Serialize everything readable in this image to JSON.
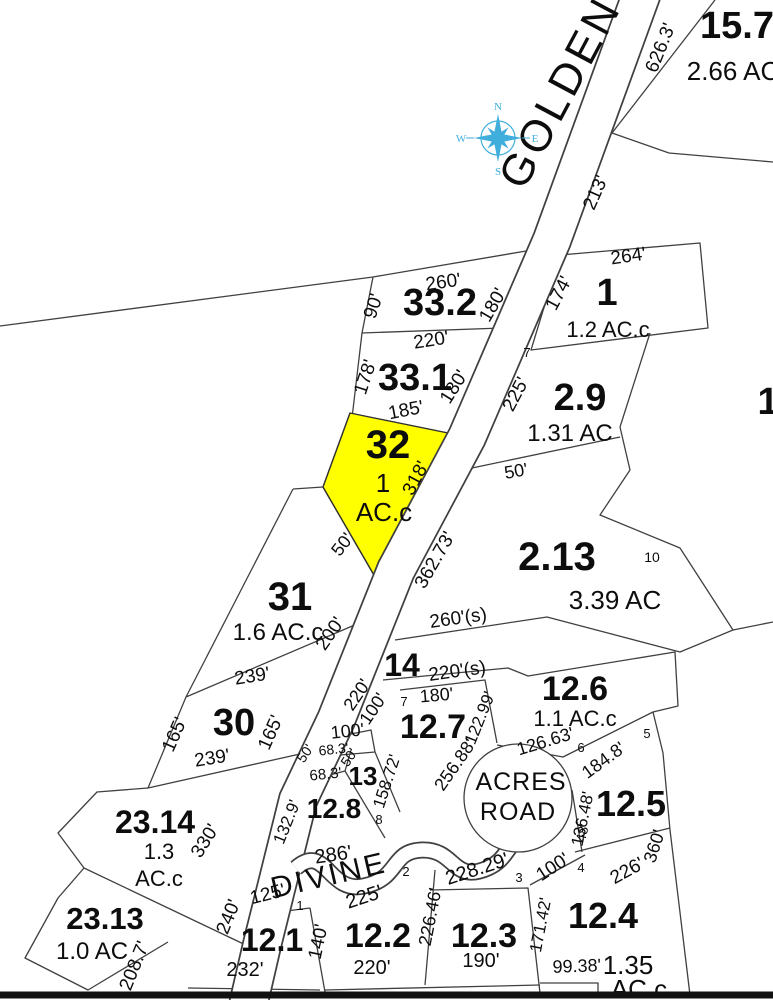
{
  "colors": {
    "highlight_parcel": "#ffff00",
    "compass": "#3FAEDC",
    "line": "#404040",
    "border": "#111111"
  },
  "compass": {
    "x": 498,
    "y": 138,
    "points": {
      "n": "N",
      "e": "E",
      "s": "S",
      "w": "W"
    }
  },
  "roads": [
    {
      "name": "GOLDEN",
      "t": "GOLDEN",
      "x": 573,
      "y": 99,
      "r": -62,
      "s": 44,
      "ls": 4
    },
    {
      "name": "DIVINE",
      "t": "DIVINE",
      "x": 331,
      "y": 885,
      "r": -13,
      "s": 30,
      "ls": 3
    },
    {
      "name": "ACRES",
      "t": "ACRES",
      "x": 521,
      "y": 790,
      "r": 0,
      "s": 25,
      "ls": 1
    },
    {
      "name": "ROAD",
      "t": "ROAD",
      "x": 518,
      "y": 820,
      "r": 0,
      "s": 25,
      "ls": 1
    }
  ],
  "parcel_numbers": [
    {
      "t": "15.7",
      "x": 737,
      "y": 38,
      "r": 0,
      "s": 38
    },
    {
      "t": "33.2",
      "x": 440,
      "y": 315,
      "r": 0,
      "s": 38
    },
    {
      "t": "33.1",
      "x": 415,
      "y": 390,
      "r": 0,
      "s": 38
    },
    {
      "t": "1",
      "x": 607,
      "y": 305,
      "r": 0,
      "s": 38
    },
    {
      "t": "2.9",
      "x": 580,
      "y": 410,
      "r": 0,
      "s": 38
    },
    {
      "t": "32",
      "x": 388,
      "y": 458,
      "r": 0,
      "s": 40
    },
    {
      "t": "31",
      "x": 290,
      "y": 610,
      "r": 0,
      "s": 40
    },
    {
      "t": "2.13",
      "x": 557,
      "y": 570,
      "r": 0,
      "s": 40
    },
    {
      "t": "30",
      "x": 234,
      "y": 735,
      "r": 0,
      "s": 38
    },
    {
      "t": "14",
      "x": 402,
      "y": 676,
      "r": 0,
      "s": 32
    },
    {
      "t": "12.7",
      "x": 433,
      "y": 738,
      "r": 0,
      "s": 34
    },
    {
      "t": "12.6",
      "x": 575,
      "y": 700,
      "r": 0,
      "s": 34
    },
    {
      "t": "12.5",
      "x": 631,
      "y": 816,
      "r": 0,
      "s": 36
    },
    {
      "t": "13",
      "x": 363,
      "y": 785,
      "r": 0,
      "s": 26
    },
    {
      "t": "12.8",
      "x": 334,
      "y": 818,
      "r": 0,
      "s": 28
    },
    {
      "t": "23.14",
      "x": 155,
      "y": 833,
      "r": 0,
      "s": 32
    },
    {
      "t": "23.13",
      "x": 105,
      "y": 929,
      "r": 0,
      "s": 31
    },
    {
      "t": "12.1",
      "x": 272,
      "y": 951,
      "r": 0,
      "s": 32
    },
    {
      "t": "12.2",
      "x": 378,
      "y": 947,
      "r": 0,
      "s": 34
    },
    {
      "t": "12.3",
      "x": 484,
      "y": 947,
      "r": 0,
      "s": 34
    },
    {
      "t": "12.4",
      "x": 603,
      "y": 928,
      "r": 0,
      "s": 36
    },
    {
      "t": "1",
      "x": 768,
      "y": 414,
      "r": 0,
      "s": 38
    }
  ],
  "areas": [
    {
      "t": "2.66 AC",
      "x": 733,
      "y": 80,
      "r": 0,
      "s": 26
    },
    {
      "t": "1.2 AC.c",
      "x": 608,
      "y": 337,
      "r": 0,
      "s": 22
    },
    {
      "t": "1.31 AC",
      "x": 570,
      "y": 441,
      "r": 0,
      "s": 24
    },
    {
      "t": "1",
      "x": 383,
      "y": 492,
      "r": 0,
      "s": 26
    },
    {
      "t": "AC.c",
      "x": 384,
      "y": 521,
      "r": 0,
      "s": 26
    },
    {
      "t": "1.6 AC.c",
      "x": 278,
      "y": 640,
      "r": 0,
      "s": 24
    },
    {
      "t": "3.39 AC",
      "x": 615,
      "y": 609,
      "r": 0,
      "s": 26
    },
    {
      "t": "1.1 AC.c",
      "x": 575,
      "y": 726,
      "r": 0,
      "s": 22
    },
    {
      "t": "1.3",
      "x": 159,
      "y": 859,
      "r": 0,
      "s": 22
    },
    {
      "t": "AC.c",
      "x": 159,
      "y": 886,
      "r": 0,
      "s": 22
    },
    {
      "t": "1.0 AC",
      "x": 92,
      "y": 959,
      "r": 0,
      "s": 24
    },
    {
      "t": "1.35",
      "x": 628,
      "y": 974,
      "r": 0,
      "s": 26
    },
    {
      "t": "AC.c",
      "x": 639,
      "y": 998,
      "r": 0,
      "s": 26
    }
  ],
  "lot_numbers": [
    {
      "t": "7",
      "x": 527,
      "y": 357,
      "r": 0,
      "s": 13
    },
    {
      "t": "10",
      "x": 652,
      "y": 562,
      "r": 0,
      "s": 14
    },
    {
      "t": "7",
      "x": 404,
      "y": 706,
      "r": 0,
      "s": 13
    },
    {
      "t": "6",
      "x": 581,
      "y": 752,
      "r": 0,
      "s": 13
    },
    {
      "t": "5",
      "x": 647,
      "y": 738,
      "r": 0,
      "s": 13
    },
    {
      "t": "8",
      "x": 379,
      "y": 824,
      "r": 0,
      "s": 13
    },
    {
      "t": "1",
      "x": 300,
      "y": 910,
      "r": 0,
      "s": 13
    },
    {
      "t": "2",
      "x": 406,
      "y": 876,
      "r": 0,
      "s": 13
    },
    {
      "t": "3",
      "x": 519,
      "y": 882,
      "r": 0,
      "s": 13
    },
    {
      "t": "4",
      "x": 581,
      "y": 872,
      "r": 0,
      "s": 13
    }
  ],
  "dimensions": [
    {
      "t": "626.3'",
      "x": 666,
      "y": 50,
      "r": -68,
      "s": 19
    },
    {
      "t": "213'",
      "x": 601,
      "y": 195,
      "r": -66,
      "s": 19
    },
    {
      "t": "260'",
      "x": 444,
      "y": 288,
      "r": -8,
      "s": 19
    },
    {
      "t": "90'",
      "x": 379,
      "y": 308,
      "r": -72,
      "s": 19
    },
    {
      "t": "180'",
      "x": 498,
      "y": 308,
      "r": -60,
      "s": 19
    },
    {
      "t": "264'",
      "x": 629,
      "y": 262,
      "r": -8,
      "s": 19
    },
    {
      "t": "174'",
      "x": 564,
      "y": 296,
      "r": -62,
      "s": 19
    },
    {
      "t": "220'",
      "x": 432,
      "y": 346,
      "r": -9,
      "s": 19
    },
    {
      "t": "178'",
      "x": 371,
      "y": 379,
      "r": -72,
      "s": 19
    },
    {
      "t": "180'",
      "x": 459,
      "y": 390,
      "r": -58,
      "s": 19
    },
    {
      "t": "185'",
      "x": 407,
      "y": 416,
      "r": -11,
      "s": 19
    },
    {
      "t": "225'",
      "x": 521,
      "y": 397,
      "r": -62,
      "s": 19
    },
    {
      "t": "50'",
      "x": 517,
      "y": 477,
      "r": -10,
      "s": 18
    },
    {
      "t": "318'",
      "x": 421,
      "y": 481,
      "r": -62,
      "s": 19
    },
    {
      "t": "50'",
      "x": 347,
      "y": 548,
      "r": -52,
      "s": 18
    },
    {
      "t": "362.73'",
      "x": 440,
      "y": 563,
      "r": -60,
      "s": 19
    },
    {
      "t": "200'",
      "x": 335,
      "y": 637,
      "r": -55,
      "s": 19
    },
    {
      "t": "260'(s)",
      "x": 459,
      "y": 624,
      "r": -8,
      "s": 19
    },
    {
      "t": "239'",
      "x": 253,
      "y": 682,
      "r": -9,
      "s": 19
    },
    {
      "t": "220'(s)",
      "x": 458,
      "y": 677,
      "r": -8,
      "s": 19
    },
    {
      "t": "165'",
      "x": 180,
      "y": 737,
      "r": -66,
      "s": 19
    },
    {
      "t": "165'",
      "x": 276,
      "y": 735,
      "r": -66,
      "s": 19
    },
    {
      "t": "239'",
      "x": 213,
      "y": 764,
      "r": -9,
      "s": 19
    },
    {
      "t": "220'",
      "x": 362,
      "y": 698,
      "r": -56,
      "s": 18
    },
    {
      "t": "100'",
      "x": 378,
      "y": 712,
      "r": -56,
      "s": 18
    },
    {
      "t": "180'",
      "x": 437,
      "y": 701,
      "r": -5,
      "s": 18
    },
    {
      "t": "100'",
      "x": 348,
      "y": 737,
      "r": -6,
      "s": 18
    },
    {
      "t": "50'",
      "x": 309,
      "y": 756,
      "r": -56,
      "s": 14
    },
    {
      "t": "68.3'",
      "x": 334,
      "y": 754,
      "r": -6,
      "s": 14
    },
    {
      "t": "50'",
      "x": 353,
      "y": 760,
      "r": -56,
      "s": 14
    },
    {
      "t": "68.3'",
      "x": 326,
      "y": 779,
      "r": -6,
      "s": 15
    },
    {
      "t": "158.72'",
      "x": 392,
      "y": 783,
      "r": -72,
      "s": 17
    },
    {
      "t": "122.99'",
      "x": 485,
      "y": 720,
      "r": -68,
      "s": 17
    },
    {
      "t": "256.88'",
      "x": 460,
      "y": 768,
      "r": -55,
      "s": 18
    },
    {
      "t": "126.63'",
      "x": 547,
      "y": 747,
      "r": -17,
      "s": 18
    },
    {
      "t": "184.8'",
      "x": 607,
      "y": 765,
      "r": -36,
      "s": 18
    },
    {
      "t": "136.48'",
      "x": 588,
      "y": 820,
      "r": -78,
      "s": 17
    },
    {
      "t": "360'",
      "x": 660,
      "y": 848,
      "r": -72,
      "s": 18
    },
    {
      "t": "330'",
      "x": 210,
      "y": 844,
      "r": -58,
      "s": 19
    },
    {
      "t": "208.7'",
      "x": 140,
      "y": 968,
      "r": -68,
      "s": 19
    },
    {
      "t": "132.9'",
      "x": 292,
      "y": 824,
      "r": -68,
      "s": 17
    },
    {
      "t": "286'",
      "x": 334,
      "y": 861,
      "r": -8,
      "s": 20
    },
    {
      "t": "240'",
      "x": 234,
      "y": 919,
      "r": -68,
      "s": 19
    },
    {
      "t": "125'",
      "x": 269,
      "y": 900,
      "r": -14,
      "s": 19
    },
    {
      "t": "232'",
      "x": 245,
      "y": 976,
      "r": 0,
      "s": 20
    },
    {
      "t": "140'",
      "x": 324,
      "y": 943,
      "r": -78,
      "s": 19
    },
    {
      "t": "225'",
      "x": 366,
      "y": 903,
      "r": -18,
      "s": 20
    },
    {
      "t": "220'",
      "x": 372,
      "y": 974,
      "r": 0,
      "s": 20
    },
    {
      "t": "226.46'",
      "x": 436,
      "y": 918,
      "r": -79,
      "s": 18
    },
    {
      "t": "190'",
      "x": 481,
      "y": 967,
      "r": 0,
      "s": 20
    },
    {
      "t": "228.29'",
      "x": 479,
      "y": 875,
      "r": -18,
      "s": 20
    },
    {
      "t": "100'",
      "x": 556,
      "y": 872,
      "r": -33,
      "s": 19
    },
    {
      "t": "48'",
      "x": 587,
      "y": 834,
      "r": -76,
      "s": 14
    },
    {
      "t": "226'",
      "x": 630,
      "y": 876,
      "r": -29,
      "s": 19
    },
    {
      "t": "171.42'",
      "x": 546,
      "y": 926,
      "r": -79,
      "s": 17
    },
    {
      "t": "99.38'",
      "x": 577,
      "y": 972,
      "r": -2,
      "s": 18
    }
  ]
}
